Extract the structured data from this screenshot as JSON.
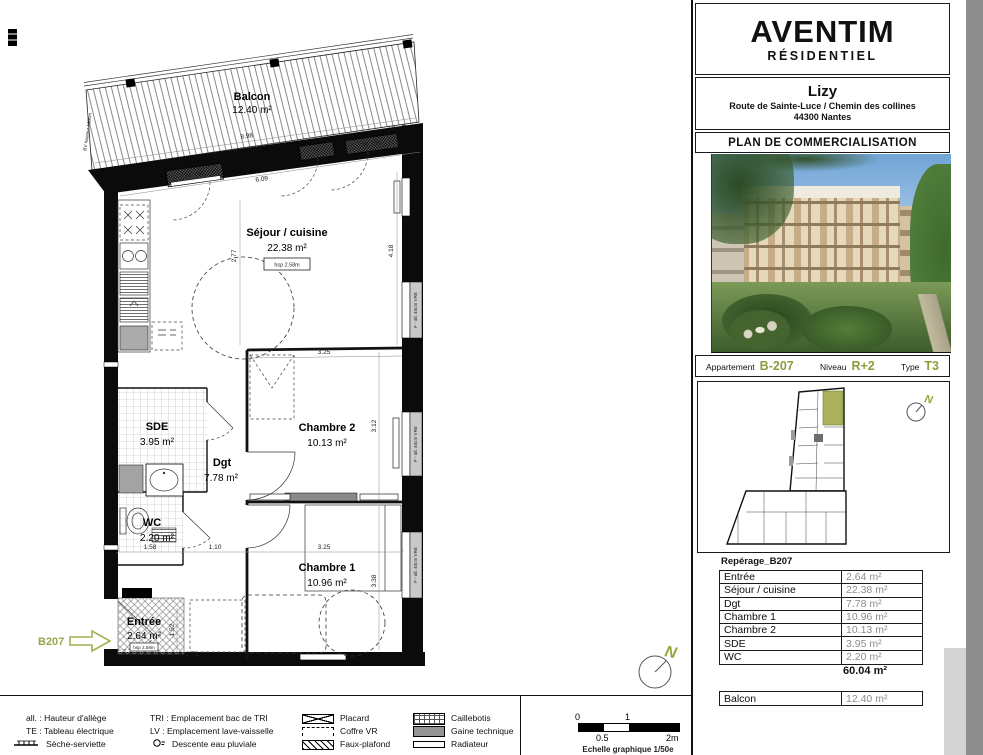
{
  "accent": {
    "olive": "#8e9c3c",
    "olive_light": "#a9b25b",
    "value_gray": "#8c8c8c"
  },
  "plan": {
    "rooms": {
      "balcon": {
        "name": "Balcon",
        "area": "12.40 m²"
      },
      "sejour": {
        "name": "Séjour / cuisine",
        "area": "22.38 m²"
      },
      "sde": {
        "name": "SDE",
        "area": "3.95 m²"
      },
      "dgt": {
        "name": "Dgt",
        "area": "7.78 m²"
      },
      "wc": {
        "name": "WC",
        "area": "2.20 m²"
      },
      "chambre2": {
        "name": "Chambre 2",
        "area": "10.13 m²"
      },
      "chambre1": {
        "name": "Chambre 1",
        "area": "10.96 m²"
      },
      "entree": {
        "name": "Entrée",
        "area": "2.64 m²"
      }
    },
    "labels": {
      "hsp": "hsp 2.58m",
      "bv": "BV hauteur 180cm",
      "ep": "EP",
      "unit_tag": "B207",
      "north": "N"
    },
    "windows": {
      "pf_vre": "PF VRE",
      "ff": "FF",
      "side": "F - all. 40cm VRE"
    },
    "dims": {
      "balcony_width": "8.98",
      "sejour_width": "6.09",
      "kitchen_depth": "2.77",
      "sejour_height": "4.18",
      "chambre2_width": "3.25",
      "chambre2_height": "3.12",
      "corridor": "1.10",
      "wc_width": "1.58",
      "chambre1_width": "3.25",
      "chambre1_height": "3.38",
      "entree_height": "1.52",
      "entree_width": "2.71"
    }
  },
  "panel": {
    "brand": {
      "name": "AVENTIM",
      "sub": "RÉSIDENTIEL"
    },
    "project": {
      "name": "Lizy",
      "address1": "Route de Sainte-Luce / Chemin des collines",
      "address2": "44300 Nantes"
    },
    "doc_title": "PLAN DE COMMERCIALISATION",
    "apartment": {
      "label": "Appartement",
      "value": "B-207",
      "level_label": "Niveau",
      "level": "R+2",
      "type_label": "Type",
      "type": "T3"
    },
    "keyplan": {
      "north": "N"
    },
    "table": {
      "title": "Repérage_B207",
      "rows": [
        {
          "label": "Entrée",
          "value": "2.64 m²"
        },
        {
          "label": "Séjour / cuisine",
          "value": "22.38 m²"
        },
        {
          "label": "Dgt",
          "value": "7.78 m²"
        },
        {
          "label": "Chambre 1",
          "value": "10.96 m²"
        },
        {
          "label": "Chambre 2",
          "value": "10.13 m²"
        },
        {
          "label": "SDE",
          "value": "3.95 m²"
        },
        {
          "label": "WC",
          "value": "2.20 m²"
        }
      ],
      "total": "60.04 m²",
      "balcony": {
        "label": "Balcon",
        "value": "12.40 m²"
      }
    }
  },
  "legend": {
    "col1": [
      {
        "text": "all. : Hauteur d'allège"
      },
      {
        "text": "TE : Tableau électrique"
      },
      {
        "text": "Sèche-serviette"
      }
    ],
    "col2": [
      {
        "text": "TRI : Emplacement bac de TRI"
      },
      {
        "text": "LV : Emplacement lave-vaisselle"
      },
      {
        "text": "Descente eau pluviale"
      }
    ],
    "col3": [
      {
        "text": "Placard"
      },
      {
        "text": "Coffre VR"
      },
      {
        "text": "Faux-plafond"
      }
    ],
    "col4": [
      {
        "text": "Caillebotis"
      },
      {
        "text": "Gaine technique"
      },
      {
        "text": "Radiateur"
      }
    ]
  },
  "scale": {
    "t0": "0",
    "t1": "1",
    "t05": "0.5",
    "t2": "2m",
    "caption": "Echelle graphique 1/50e"
  }
}
